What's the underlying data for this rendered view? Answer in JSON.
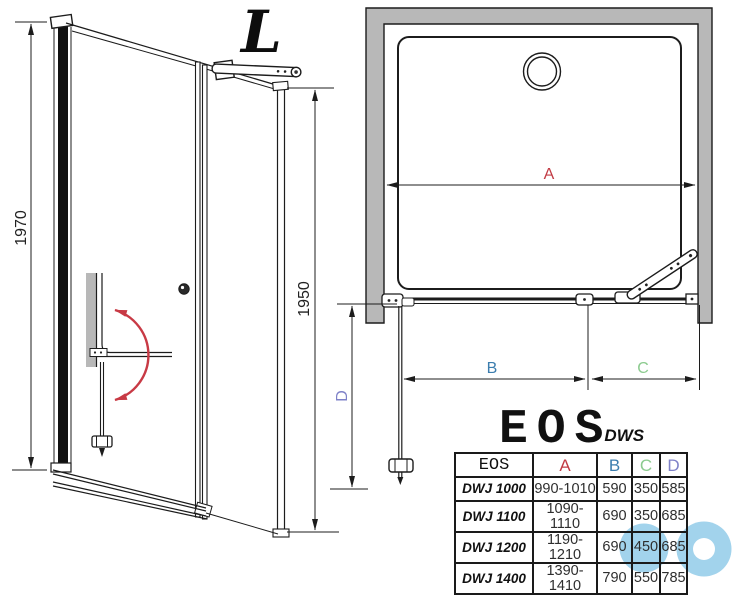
{
  "drawing": {
    "variant_label": "L",
    "elevation": {
      "outer_height": "1970",
      "inner_height": "1950"
    },
    "plan": {
      "width_label": "A",
      "door_width_label": "B",
      "fixed_width_label": "C",
      "open_door_label": "D"
    }
  },
  "logo": {
    "brand": "EOS",
    "series": "DWS"
  },
  "table": {
    "headers": [
      "EOS",
      "A",
      "B",
      "C",
      "D"
    ],
    "rows": [
      [
        "DWJ 1000",
        "990-1010",
        "590",
        "350",
        "585"
      ],
      [
        "DWJ 1100",
        "1090-1110",
        "690",
        "350",
        "685"
      ],
      [
        "DWJ 1200",
        "1190-1210",
        "690",
        "450",
        "685"
      ],
      [
        "DWJ 1400",
        "1390-1410",
        "790",
        "550",
        "785"
      ]
    ]
  },
  "colors": {
    "dim_a_red": "#c23b44",
    "dim_b_blue": "#3b7dae",
    "dim_c_green": "#8ccb8f",
    "dim_d_violet": "#7e81c8",
    "wall_gray": "#b8b8b8",
    "swing_arrow_red": "#c83a45",
    "watermark_blue": "#a2d3ec"
  }
}
